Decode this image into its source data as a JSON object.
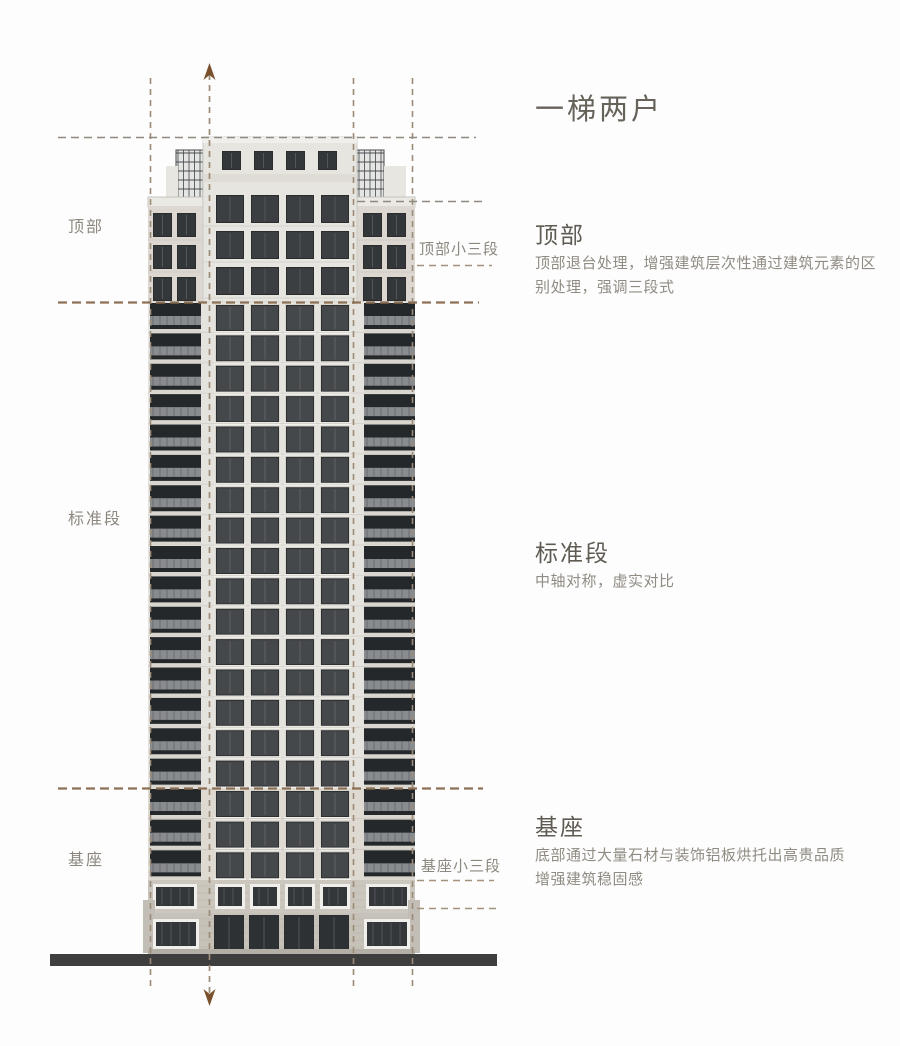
{
  "title": "一梯两户",
  "sections": [
    {
      "heading": "顶部",
      "body": "顶部退台处理，增强建筑层次性通过建筑元素的区\n别处理，强调三段式"
    },
    {
      "heading": "标准段",
      "body": "中轴对称，虚实对比"
    },
    {
      "heading": "基座",
      "body": "底部通过大量石材与装饰铝板烘托出高贵品质\n增强建筑稳固感"
    }
  ],
  "figure_labels": {
    "left": [
      {
        "text": "顶部"
      },
      {
        "text": "标准段"
      },
      {
        "text": "基座"
      }
    ],
    "callouts": [
      {
        "text": "顶部小三段"
      },
      {
        "text": "基座小三段"
      }
    ]
  },
  "figure": {
    "type": "building-elevation-diagram",
    "standard_floors": 16,
    "base_floors": 3,
    "tower_top_floors": 3
  },
  "colors": {
    "title_text": "#67635a",
    "heading_text": "#5f5b52",
    "body_text": "#908c83",
    "label_text": "#8c887f",
    "guide_gray": "#8f897f",
    "guide_tan": "#a3917b",
    "accent_brown": "#8c7156",
    "axis_line": "#9b8b77",
    "arrow_brown": "#7a4f2c",
    "ground": "#3e3e3e"
  }
}
